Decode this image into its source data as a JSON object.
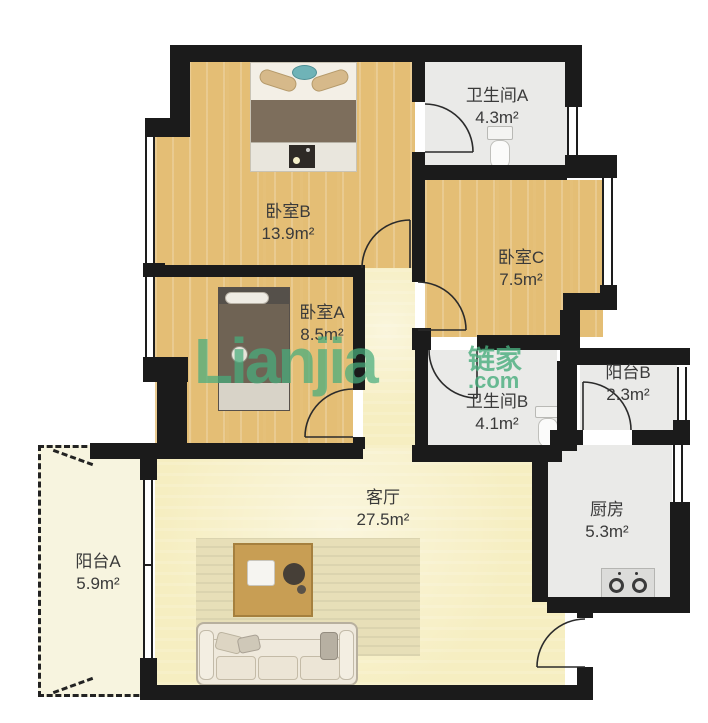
{
  "watermark": {
    "logo": "Lianjia",
    "brand": "链家",
    "suffix": ".com",
    "color": "#48ad7d"
  },
  "rooms": {
    "bedroom_b": {
      "name": "卧室B",
      "area": "13.9m²"
    },
    "bathroom_a": {
      "name": "卫生间A",
      "area": "4.3m²"
    },
    "bedroom_c": {
      "name": "卧室C",
      "area": "7.5m²"
    },
    "bedroom_a": {
      "name": "卧室A",
      "area": "8.5m²"
    },
    "bathroom_b": {
      "name": "卫生间B",
      "area": "4.1m²"
    },
    "balcony_b": {
      "name": "阳台B",
      "area": "2.3m²"
    },
    "living_room": {
      "name": "客厅",
      "area": "27.5m²"
    },
    "kitchen": {
      "name": "厨房",
      "area": "5.3m²"
    },
    "balcony_a": {
      "name": "阳台A",
      "area": "5.9m²"
    }
  },
  "colors": {
    "wall": "#1b1b1b",
    "wood_floor": "#eec87e",
    "living_floor": "#f6eec1",
    "tile_floor": "#eaeae8",
    "balcony_floor": "#f7f4df",
    "watermark_green": "#48ad7d"
  }
}
